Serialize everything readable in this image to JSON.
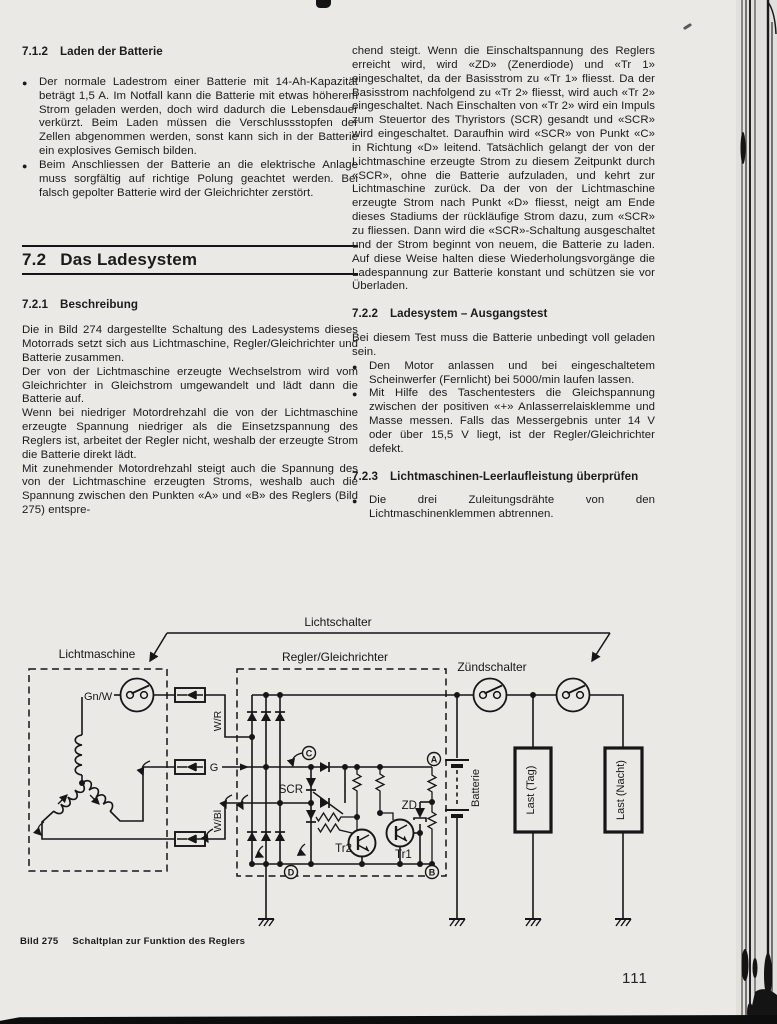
{
  "page": {
    "number": "111"
  },
  "figure": {
    "num": "Bild 275",
    "title": "Schaltplan zur Funktion des Reglers"
  },
  "sections": {
    "s712": {
      "num": "7.1.2",
      "title": "Laden der Batterie",
      "bullets": [
        "Der normale Ladestrom einer Batterie mit 14-Ah-Kapazität beträgt 1,5 A. Im Notfall kann die Batterie mit etwas höherem Strom geladen werden, doch wird dadurch die Lebensdauer verkürzt. Beim Laden müssen die Verschlussstopfen der Zellen abgenommen werden, sonst kann sich in der Batterie ein explosives Gemisch bilden.",
        "Beim Anschliessen der Batterie an die elektrische Anlage muss sorgfältig auf richtige Polung geachtet werden. Bei falsch gepolter Batterie wird der Gleichrichter zerstört."
      ]
    },
    "s72": {
      "num": "7.2",
      "title": "Das Ladesystem"
    },
    "s721": {
      "num": "7.2.1",
      "title": "Beschreibung",
      "paragraphs": [
        "Die in Bild 274 dargestellte Schaltung des Ladesystems dieses Motorrads setzt sich aus Lichtmaschine, Regler/Gleichrichter und Batterie zusammen.",
        "Der von der Lichtmaschine erzeugte Wechselstrom wird vom Gleichrichter in Gleichstrom umgewandelt und lädt dann die Batterie auf.",
        "Wenn bei niedriger Motordrehzahl die von der Lichtmaschine erzeugte Spannung niedriger als die Einsetzspannung des Reglers ist, arbeitet der Regler nicht, weshalb der erzeugte Strom die Batterie direkt lädt.",
        "Mit zunehmender Motordrehzahl steigt auch die Spannung des von der Lichtmaschine erzeugten Stroms, weshalb auch die Spannung zwischen den Punkten «A» und «B» des Reglers (Bild 275) entspre-"
      ]
    },
    "s72_cont": {
      "paragraph": "chend steigt. Wenn die Einschaltspannung des Reglers erreicht wird, wird «ZD» (Zenerdiode) und «Tr 1» eingeschaltet, da der Basisstrom zu «Tr 1» fliesst. Da der Basisstrom nachfolgend zu «Tr 2» fliesst, wird auch «Tr 2» eingeschaltet. Nach Einschalten von «Tr 2» wird ein Impuls zum Steuertor des Thyristors (SCR) gesandt und «SCR» wird eingeschaltet. Daraufhin wird «SCR» von Punkt «C» in Richtung «D» leitend. Tatsächlich gelangt der von der Lichtmaschine erzeugte Strom zu diesem Zeitpunkt durch «SCR», ohne die Batterie aufzuladen, und kehrt zur Lichtmaschine zurück. Da der von der Lichtmaschine erzeugte Strom nach Punkt «D» fliesst, neigt am Ende dieses Stadiums der rückläufige Strom dazu, zum «SCR» zu fliessen. Dann wird die «SCR»-Schaltung ausgeschaltet und der Strom beginnt von neuem, die Batterie zu laden. Auf diese Weise halten diese Wiederholungsvorgänge die Ladespannung zur Batterie konstant und schützen sie vor Überladen."
    },
    "s722": {
      "num": "7.2.2",
      "title": "Ladesystem – Ausgangstest",
      "intro": "Bei diesem Test muss die Batterie unbedingt voll geladen sein.",
      "bullets": [
        "Den Motor anlassen und bei eingeschaltetem Scheinwerfer (Fernlicht) bei 5000/min laufen lassen.",
        "Mit Hilfe des Taschentesters die Gleichspannung zwischen der positiven «+» Anlasserrelaisklemme und Masse messen. Falls das Messergebnis unter 14 V oder über 15,5 V liegt, ist der Regler/Gleichrichter defekt."
      ]
    },
    "s723": {
      "num": "7.2.3",
      "title": "Lichtmaschinen-Leerlaufleistung überprüfen",
      "bullets": [
        "Die drei Zuleitungsdrähte von den Lichtmaschinenklemmen abtrennen."
      ]
    }
  },
  "diagram": {
    "lichtschalter": "Lichtschalter",
    "lichtmaschine": "Lichtmaschine",
    "regler_gleichrichter": "Regler/Gleichrichter",
    "zuendschalter": "Zündschalter",
    "wire_gnw": "Gn/W",
    "wire_wr": "W/R",
    "wire_g": "G",
    "wire_wbl": "W/Bl",
    "scr": "SCR",
    "tr2": "Tr2",
    "tr1": "Tr1",
    "zd": "ZD",
    "node_a": "A",
    "node_b": "B",
    "node_c": "C",
    "node_d": "D",
    "batterie": "Batterie",
    "last_tag": "Last (Tag)",
    "last_nacht": "Last (Nacht)"
  },
  "colors": {
    "paper": "#eae9e6",
    "ink": "#161616"
  }
}
